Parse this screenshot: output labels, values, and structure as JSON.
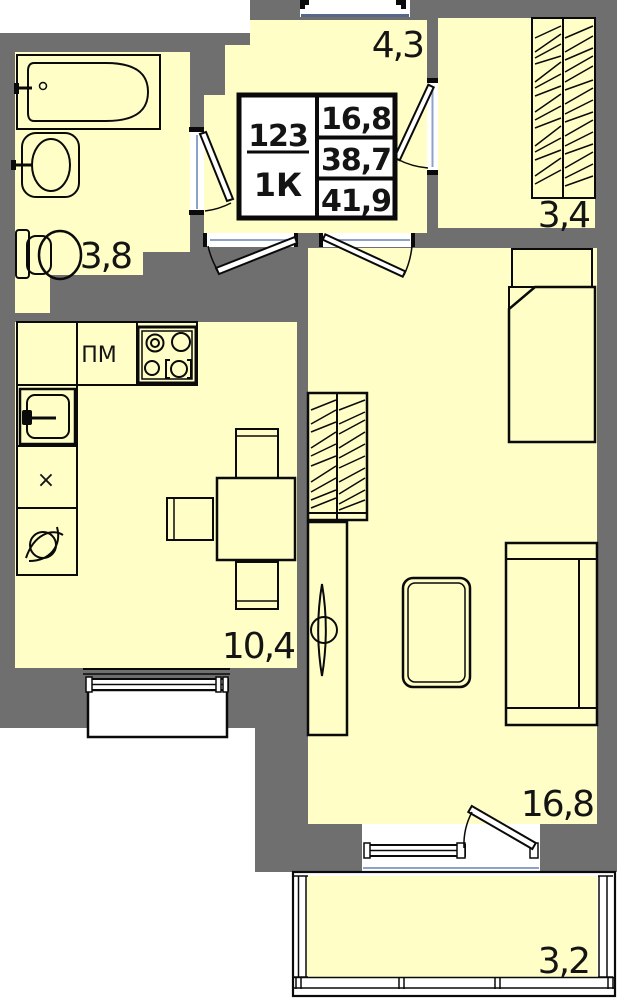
{
  "stamp": {
    "apartment_number": "123",
    "rooms_type": "1К",
    "living_area": "16,8",
    "apartment_area": "38,7",
    "total_area": "41,9"
  },
  "rooms": {
    "hallway": {
      "label": "4,3"
    },
    "storage": {
      "label": "3,4"
    },
    "bathroom": {
      "label": "3,8"
    },
    "kitchen": {
      "label": "10,4"
    },
    "living": {
      "label": "16,8"
    },
    "balcony": {
      "label": "3,2"
    }
  },
  "fixtures": {
    "dishwasher_label": "ПМ",
    "vent_label": "×"
  },
  "colors": {
    "wall": "#6F6F6F",
    "floor": "#FEFEC6",
    "outside": "#FFFFFF",
    "frame_blue": "#8CA3C7",
    "line": "#0A0A0A"
  }
}
